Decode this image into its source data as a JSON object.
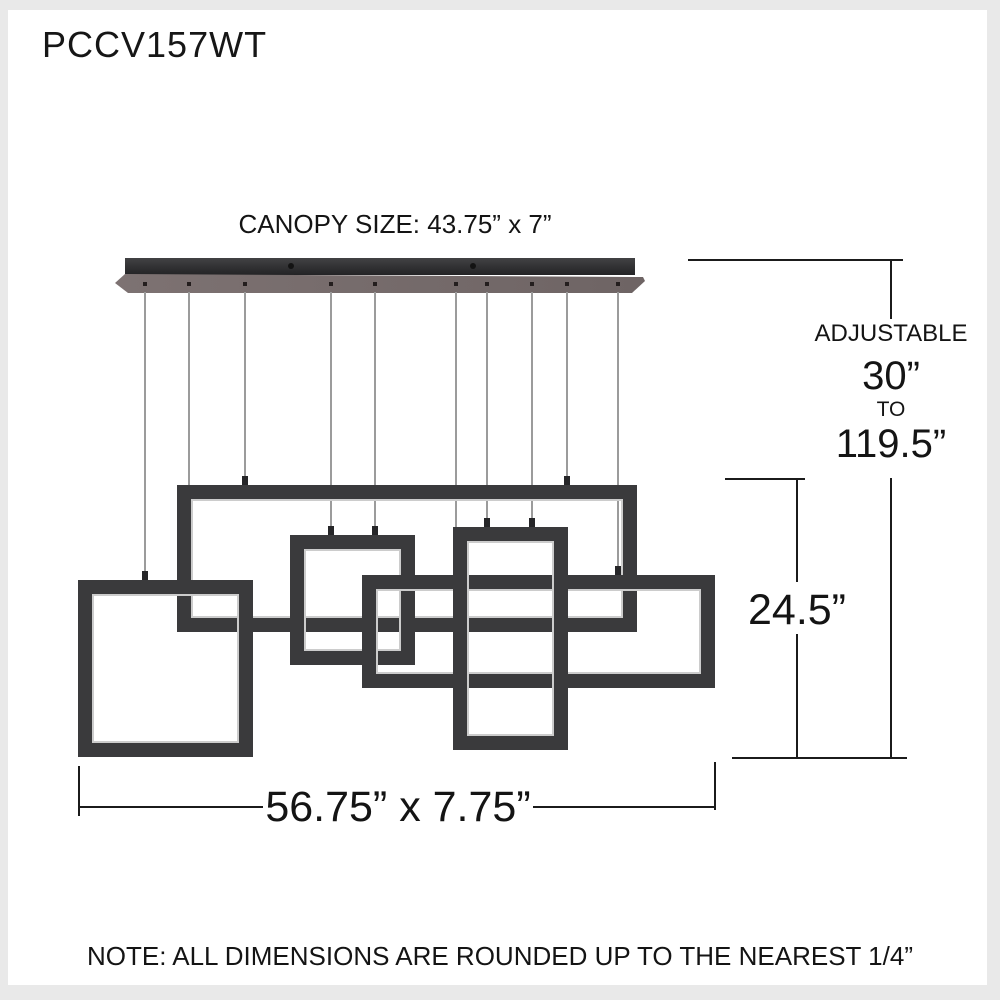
{
  "title": {
    "model": "PCCV157WT"
  },
  "canopy": {
    "label": "CANOPY SIZE: 43.75” x 7”"
  },
  "dimensions": {
    "adjustable_label": "ADJUSTABLE",
    "min_height": "30”",
    "to_label": "TO",
    "max_height": "119.5”",
    "frame_height": "24.5”",
    "overall_size": "56.75” x 7.75”"
  },
  "note": {
    "text": "NOTE: ALL DIMENSIONS ARE ROUNDED UP TO THE NEAREST 1/4”"
  },
  "fixture": {
    "frame_count": 5,
    "cable_count": 10
  },
  "colors": {
    "frame": "#3a3a3c",
    "canopy_bar": "#303032",
    "canopy_plate": "#756b6b",
    "cable": "#9b9b9b",
    "dimension_line": "#1b1b1b",
    "led_strip": "#cccccc",
    "page_border": "#e9e9e9"
  }
}
